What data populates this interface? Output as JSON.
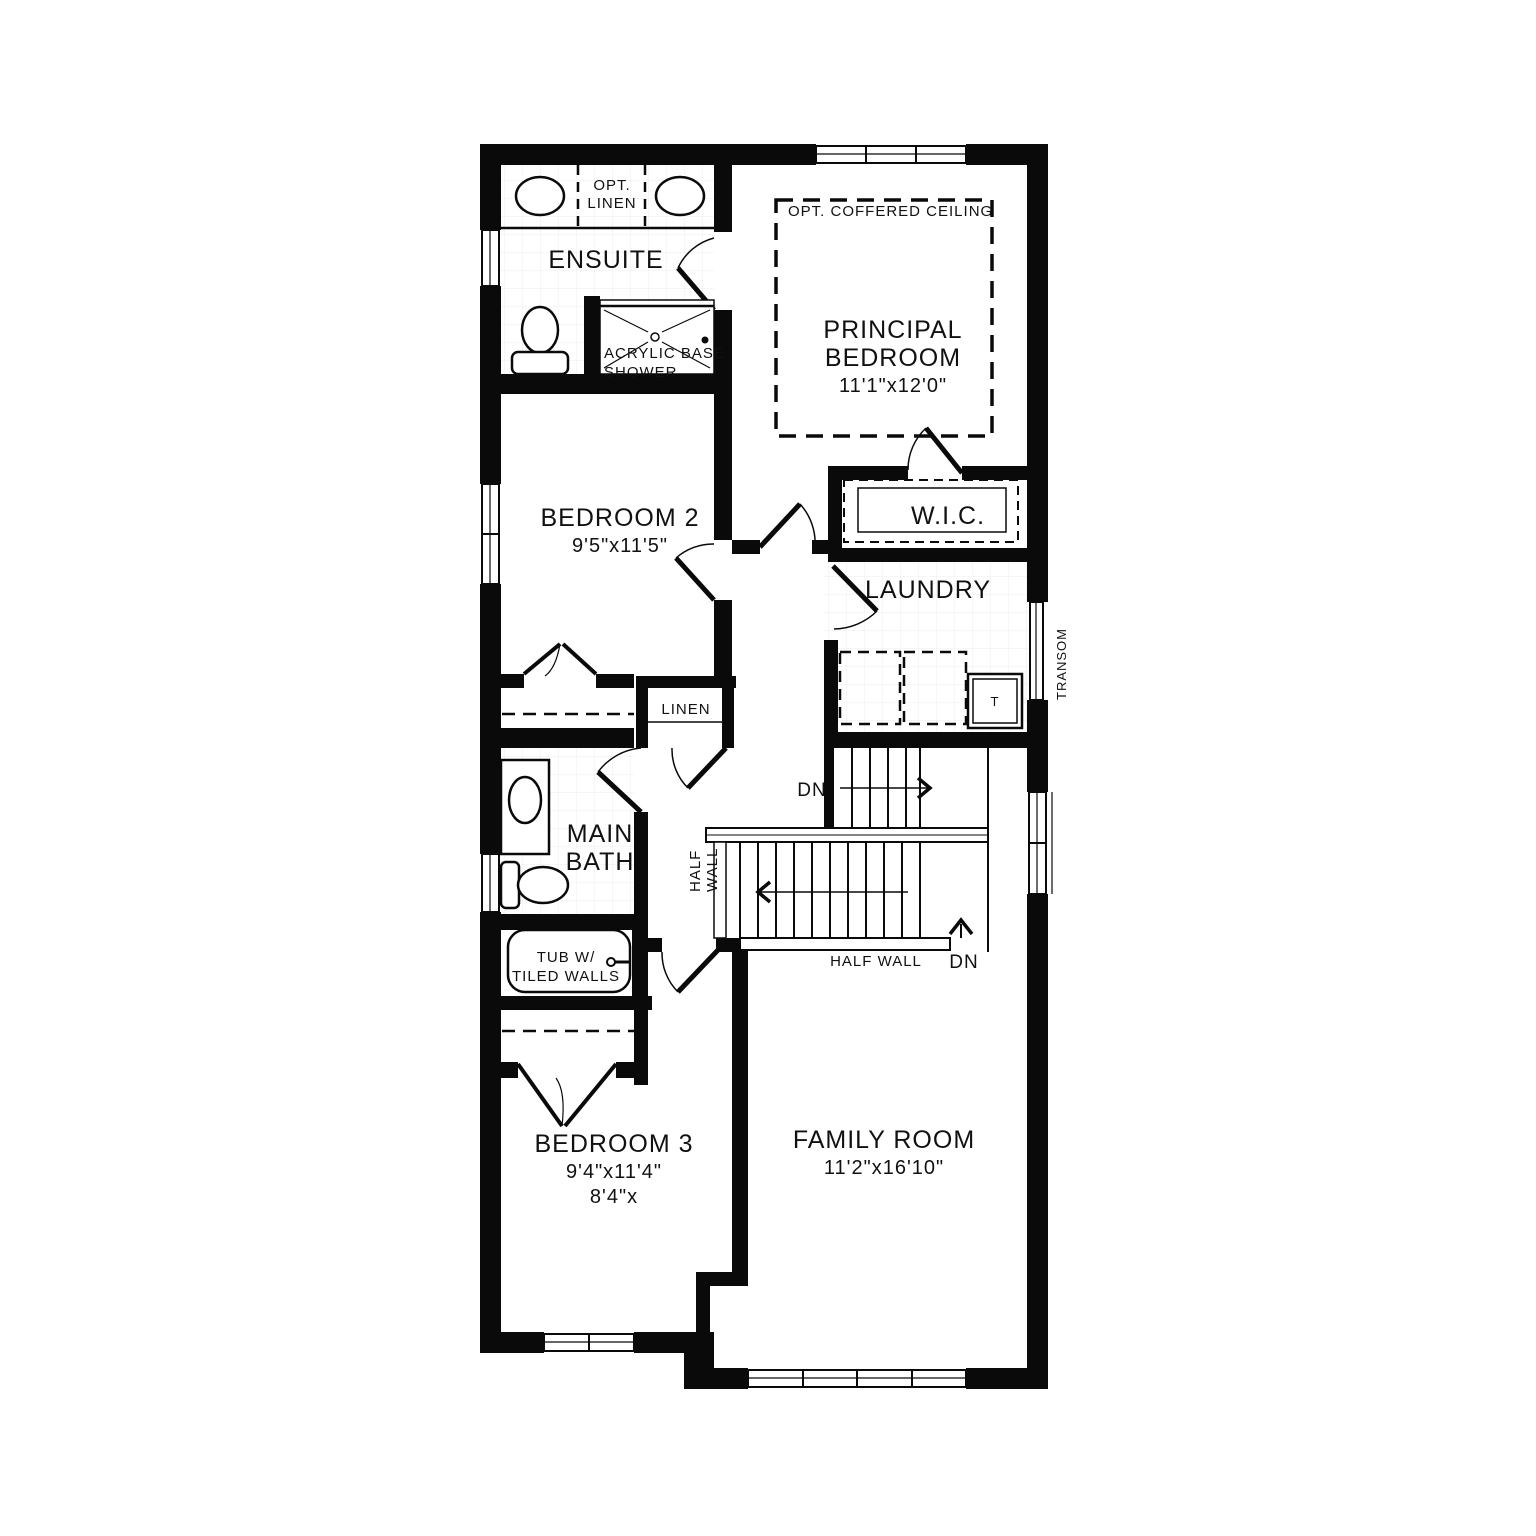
{
  "plan_title": "Second Floor Plan",
  "colors": {
    "wall": "#0a0a0a",
    "background": "#ffffff",
    "tile_grid": "#ececec",
    "line": "#0a0a0a"
  },
  "rooms": {
    "ensuite": {
      "label": "ENSUITE"
    },
    "principal": {
      "line1": "PRINCIPAL",
      "line2": "BEDROOM",
      "dims": "11'1\"x12'0\""
    },
    "bedroom2": {
      "label": "BEDROOM 2",
      "dims": "9'5\"x11'5\""
    },
    "wic": {
      "label": "W.I.C."
    },
    "laundry": {
      "label": "LAUNDRY"
    },
    "main_bath": {
      "line1": "MAIN",
      "line2": "BATH"
    },
    "bedroom3": {
      "label": "BEDROOM 3",
      "dims": "9'4\"x11'4\"",
      "dims2": "8'4\"x"
    },
    "family": {
      "label": "FAMILY ROOM",
      "dims": "11'2\"x16'10\""
    }
  },
  "annotations": {
    "opt_linen_line1": "OPT.",
    "opt_linen_line2": "LINEN",
    "coffered_ceiling": "OPT. COFFERED CEILING",
    "shower_line1": "ACRYLIC BASE",
    "shower_line2": "SHOWER",
    "linen_closet": "LINEN",
    "transom": "TRANSOM",
    "laundry_tub": "T",
    "dn_upper": "DN",
    "dn_lower": "DN",
    "half_wall_vert_line1": "HALF",
    "half_wall_vert_line2": "WALL",
    "half_wall_horiz": "HALF WALL",
    "tub_line1": "TUB W/",
    "tub_line2": "TILED WALLS"
  }
}
